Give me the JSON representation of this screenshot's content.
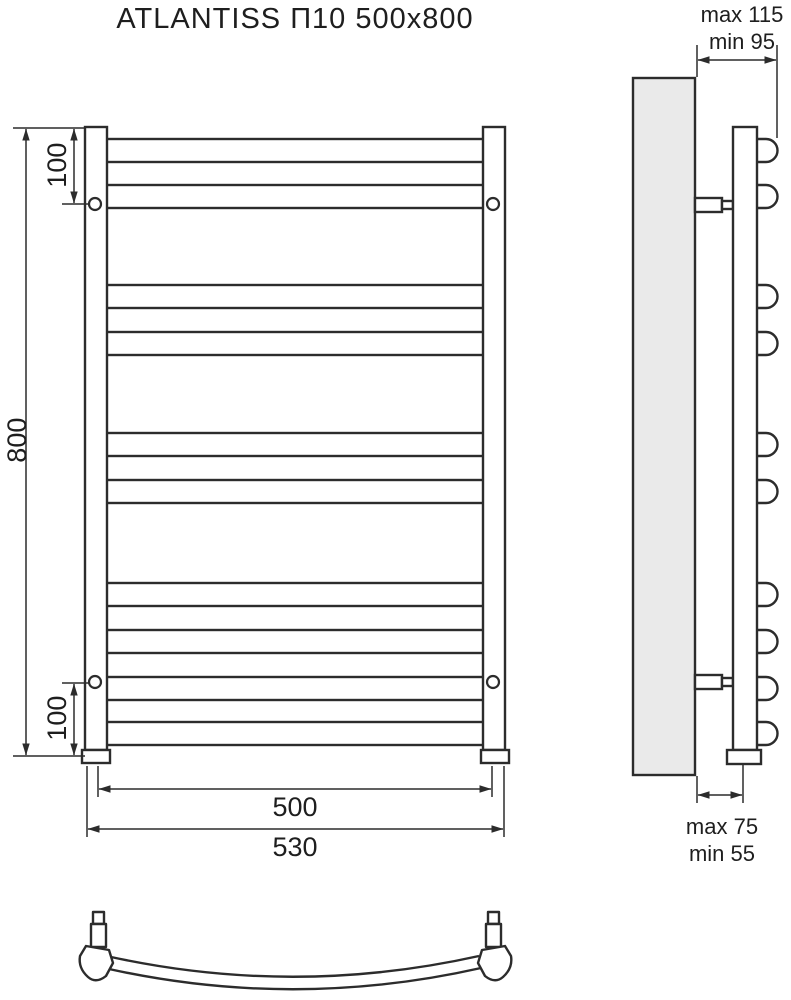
{
  "title": "ATLANTISS П10 500x800",
  "front_view": {
    "overall_height": "800",
    "top_bracket_offset": "100",
    "bottom_bracket_offset": "100",
    "rail_width": "500",
    "overall_width": "530",
    "rung_count": 10
  },
  "side_view": {
    "wall_clearance_top": {
      "max": "max 115",
      "min": "min 95"
    },
    "wall_clearance_bottom": {
      "max": "max 75",
      "min": "min 55"
    }
  },
  "colors": {
    "line": "#2c2c2c",
    "wall_fill": "#eaeaea",
    "background": "#ffffff"
  }
}
